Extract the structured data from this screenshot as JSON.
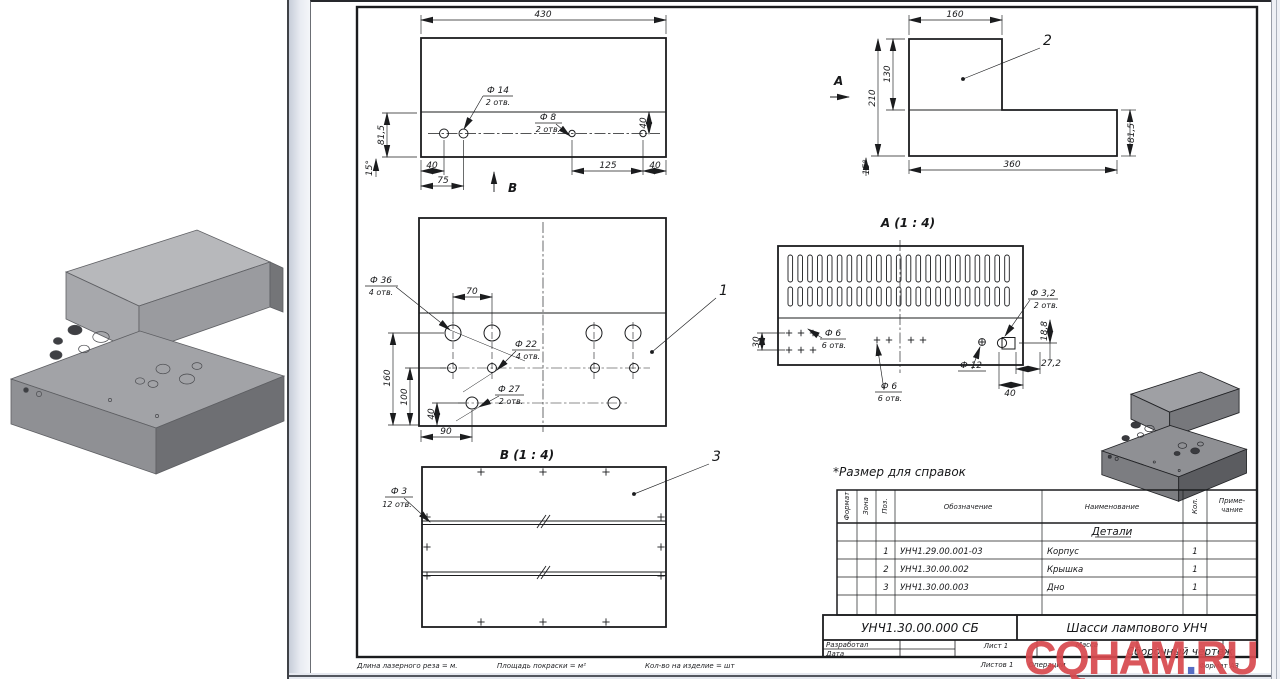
{
  "note": "*Размер для справок",
  "view_top": {
    "dim430": "430",
    "dim815": "81,5",
    "dim15": "15°",
    "dim40_left": "40",
    "dim75": "75",
    "dim125": "125",
    "dim40_right": "40",
    "dim40_vert": "40",
    "hole14": "Ф 14",
    "hole14_qty": "2 отв.",
    "hole8": "Ф 8",
    "hole8_qty": "2 отв.",
    "view_arrow": "В"
  },
  "view_side": {
    "dim160": "160",
    "dim130": "130",
    "dim210": "210",
    "dim360": "360",
    "dim815": "81,5",
    "dim15": "15°",
    "view_arrow": "А",
    "part_ref": "2"
  },
  "view_face": {
    "hole36": "Ф 36",
    "hole36_qty": "4 отв.",
    "dim70": "70",
    "hole22": "Ф 22",
    "hole22_qty": "4 отв.",
    "hole27": "Ф 27",
    "hole27_qty": "2 отв.",
    "dim160": "160",
    "dim100": "100",
    "dim40": "40",
    "dim90": "90",
    "part_ref": "1"
  },
  "view_b": {
    "title": "В (1 : 4)",
    "hole3": "Ф 3",
    "hole3_qty": "12 отв.",
    "part_ref": "3"
  },
  "view_a": {
    "title": "А (1 : 4)",
    "dim30": "30",
    "hole6_left": "Ф 6",
    "hole6_left_qty": "6 отв.",
    "hole6_mid": "Ф 6",
    "hole6_mid_qty": "6 отв.",
    "hole12": "Ф 12",
    "hole32": "Ф 3,2",
    "hole32_qty": "2 отв.",
    "dim188": "18,8",
    "dim272": "27,2",
    "dim40": "40",
    "vent_slot_columns": 23,
    "vent_slot_rows": 2
  },
  "spec_table": {
    "headers": {
      "format": "Формат",
      "zone": "Зона",
      "pos": "Поз.",
      "designation": "Обозначение",
      "name": "Наименование",
      "qty": "Кол.",
      "note_line1": "Приме-",
      "note_line2": "чание"
    },
    "section": "Детали",
    "rows": [
      {
        "pos": "1",
        "designation": "УНЧ1.29.00.001-03",
        "name": "Корпус",
        "qty": "1"
      },
      {
        "pos": "2",
        "designation": "УНЧ1.30.00.002",
        "name": "Крышка",
        "qty": "1"
      },
      {
        "pos": "3",
        "designation": "УНЧ1.30.00.003",
        "name": "Дно",
        "qty": "1"
      }
    ]
  },
  "title_block": {
    "doc_number": "УНЧ1.30.00.000  СБ",
    "product_name": "Шасси лампового УНЧ",
    "doc_type": "Сборочный чертеж",
    "developed_label": "Разработал",
    "date_label": "Дата",
    "sheet_label": "Лист 1",
    "mass_label": "Масса",
    "sheets_label": "Листов 1",
    "operations_label": "Операции",
    "format_label": "Формат А3"
  },
  "footer": {
    "laser_length": "Длина лазерного реза = м.",
    "paint_area": "Площадь покраски = м²",
    "qty_per_item": "Кол-во на изделие = шт"
  },
  "watermark": {
    "part1": "CQHAM",
    "dot": ".",
    "part2": "RU",
    "color": "#d84a4f",
    "dot_color": "#4a63c0"
  },
  "colors": {
    "line": "#1b1c1e",
    "metal_light": "#b4b5b8",
    "metal_mid": "#9c9da1",
    "metal_dark": "#707174"
  }
}
